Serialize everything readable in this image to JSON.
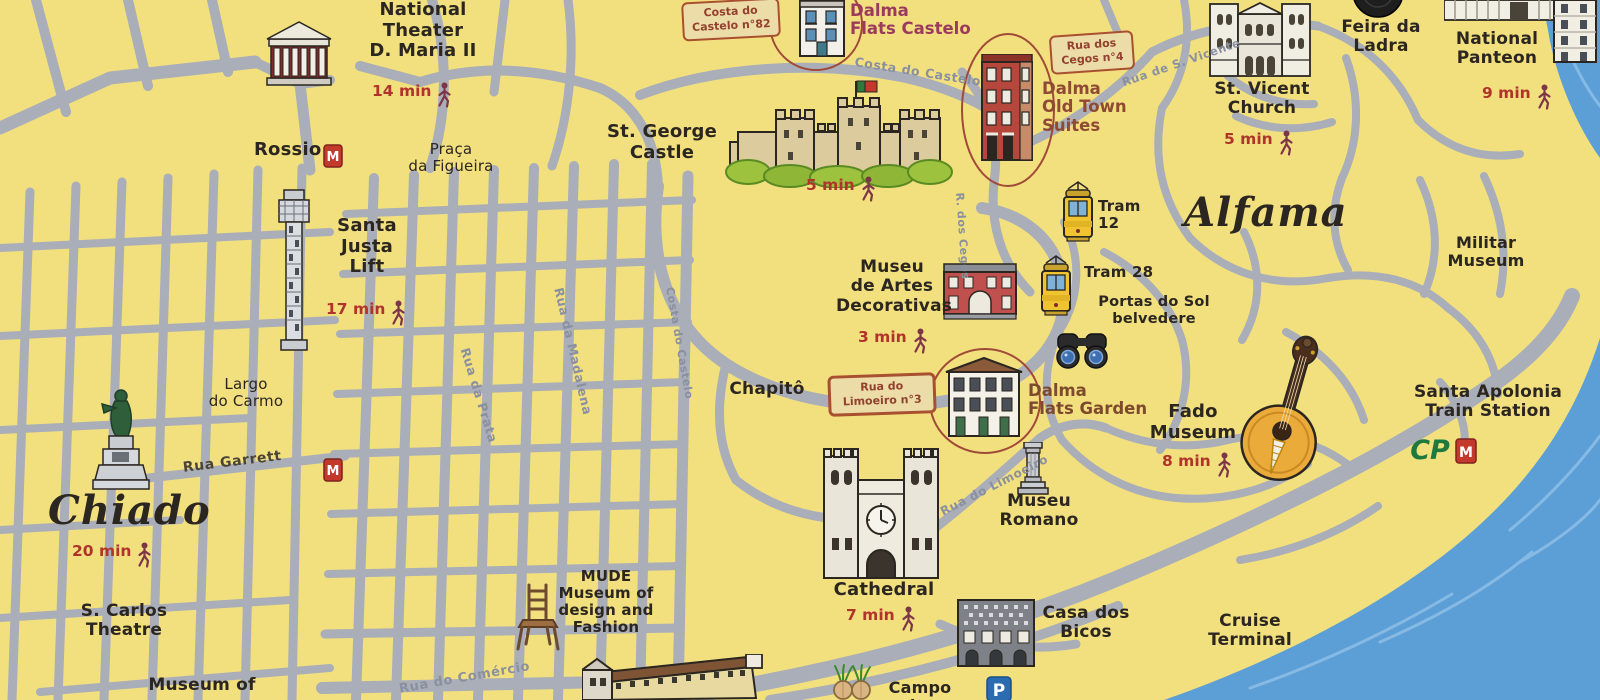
{
  "map": {
    "colors": {
      "background": "#F2DF7E",
      "street": "#A9AEB8",
      "river": "#5C9FD6",
      "ink": "#2B2620",
      "walk_time_red": "#B0342B",
      "street_label_gray": "#8A90A0",
      "dalma_castelo_label": "#9C3A5E",
      "dalma_old_town_label": "#8E4A34",
      "dalma_garden_label": "#7E4A2E",
      "address_box_bg": "#EBDCA8",
      "address_box_border": "#A8502F"
    },
    "neighborhoods": {
      "chiado": {
        "label": "Chiado",
        "walk_time": "20 min"
      },
      "alfama": {
        "label": "Alfama"
      }
    },
    "landmarks": {
      "national_theater": {
        "label": "National\nTheater\nD. Maria II",
        "walk_time": "14 min"
      },
      "rossio": {
        "label": "Rossio"
      },
      "praca_da_figueira": {
        "label": "Praça\nda Figueira"
      },
      "santa_justa": {
        "label": "Santa\nJusta\nLift",
        "walk_time": "17 min"
      },
      "largo_do_carmo": {
        "label": "Largo\ndo Carmo"
      },
      "s_carlos_theatre": {
        "label": "S. Carlos\nTheatre"
      },
      "museum_of": {
        "label": "Museum of"
      },
      "st_george_castle": {
        "label": "St. George\nCastle",
        "walk_time": "5 min"
      },
      "museu_artes_decorativas": {
        "label": "Museu\nde Artes\nDecorativas",
        "walk_time": "3 min"
      },
      "chapito": {
        "label": "Chapitô"
      },
      "portas_do_sol": {
        "label": "Portas do Sol\nbelvedere"
      },
      "fado_museum": {
        "label": "Fado\nMuseum",
        "walk_time": "8 min"
      },
      "st_vicent_church": {
        "label": "St. Vicent\nChurch",
        "walk_time": "5 min"
      },
      "feira_da_ladra": {
        "label": "Feira da\nLadra"
      },
      "national_panteon": {
        "label": "National\nPanteon",
        "walk_time": "9 min"
      },
      "militar_museum": {
        "label": "Militar\nMuseum"
      },
      "santa_apolonia": {
        "label": "Santa Apolonia\nTrain Station"
      },
      "cathedral": {
        "label": "Cathedral",
        "walk_time": "7 min"
      },
      "museu_romano": {
        "label": "Museu\nRomano"
      },
      "casa_dos_bicos": {
        "label": "Casa dos\nBicos"
      },
      "cruise_terminal": {
        "label": "Cruise\nTerminal"
      },
      "mude": {
        "label": "MUDE\nMuseum of\ndesign and\nFashion"
      },
      "campo_das": {
        "label": "Campo das"
      }
    },
    "properties": {
      "castelo": {
        "address": "Costa do\nCastelo n°82",
        "name": "Dalma\nFlats Castelo"
      },
      "old_town": {
        "address": "Rua dos\nCegos n°4",
        "name": "Dalma\nOld Town\nSuites"
      },
      "garden": {
        "address": "Rua do\nLimoeiro n°3",
        "name": "Dalma\nFlats Garden"
      }
    },
    "transit": {
      "tram12": {
        "label": "Tram\n12"
      },
      "tram28": {
        "label": "Tram 28"
      },
      "metro": {
        "label": "M"
      },
      "cp": {
        "label": "CP"
      },
      "parking": {
        "label": "P"
      }
    },
    "streets": {
      "rua_da_prata": "Rua da Prata",
      "rua_da_madalena": "Rua da Madalena",
      "costa_do_castelo_upper": "Costa do Castelo",
      "costa_do_castelo_lower": "Costa do Castelo",
      "rua_garrett": "Rua Garrett",
      "rua_de_s_vicente": "Rua de S. Vicente",
      "r_dos_cegos": "R. dos Cegos",
      "rua_do_limoeiro": "Rua do Limoeiro",
      "rua_do_comercio": "Rua do Comércio"
    }
  }
}
